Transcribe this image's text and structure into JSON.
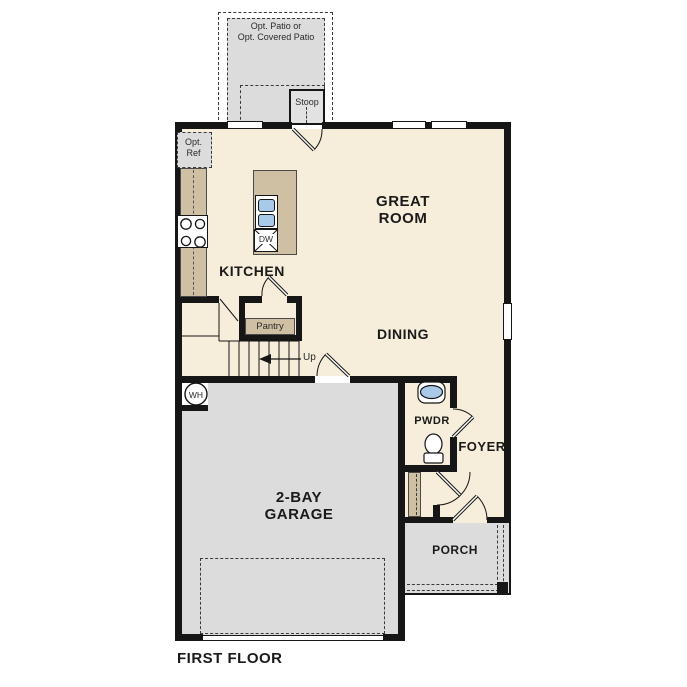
{
  "colors": {
    "wall": "#161616",
    "floor": "#f6edda",
    "concrete": "#dcdcdc",
    "counter_tan": "#cfc0a3",
    "fixture_blue": "#a9c9e8",
    "background": "#ffffff"
  },
  "plan": {
    "title": "FIRST FLOOR",
    "patio": {
      "line1": "Opt. Patio or",
      "line2": "Opt. Covered Patio"
    },
    "stoop_label": "Stoop",
    "opt_ref": {
      "line1": "Opt.",
      "line2": "Ref"
    },
    "kitchen_label": "KITCHEN",
    "great_room": {
      "line1": "GREAT",
      "line2": "ROOM"
    },
    "dining_label": "DINING",
    "pantry_label": "Pantry",
    "up_label": "Up",
    "dw_label": "DW",
    "wh_label": "WH",
    "garage": {
      "line1": "2-BAY",
      "line2": "GARAGE"
    },
    "pwdr_label": "PWDR",
    "foyer_label": "FOYER",
    "porch_label": "PORCH"
  }
}
